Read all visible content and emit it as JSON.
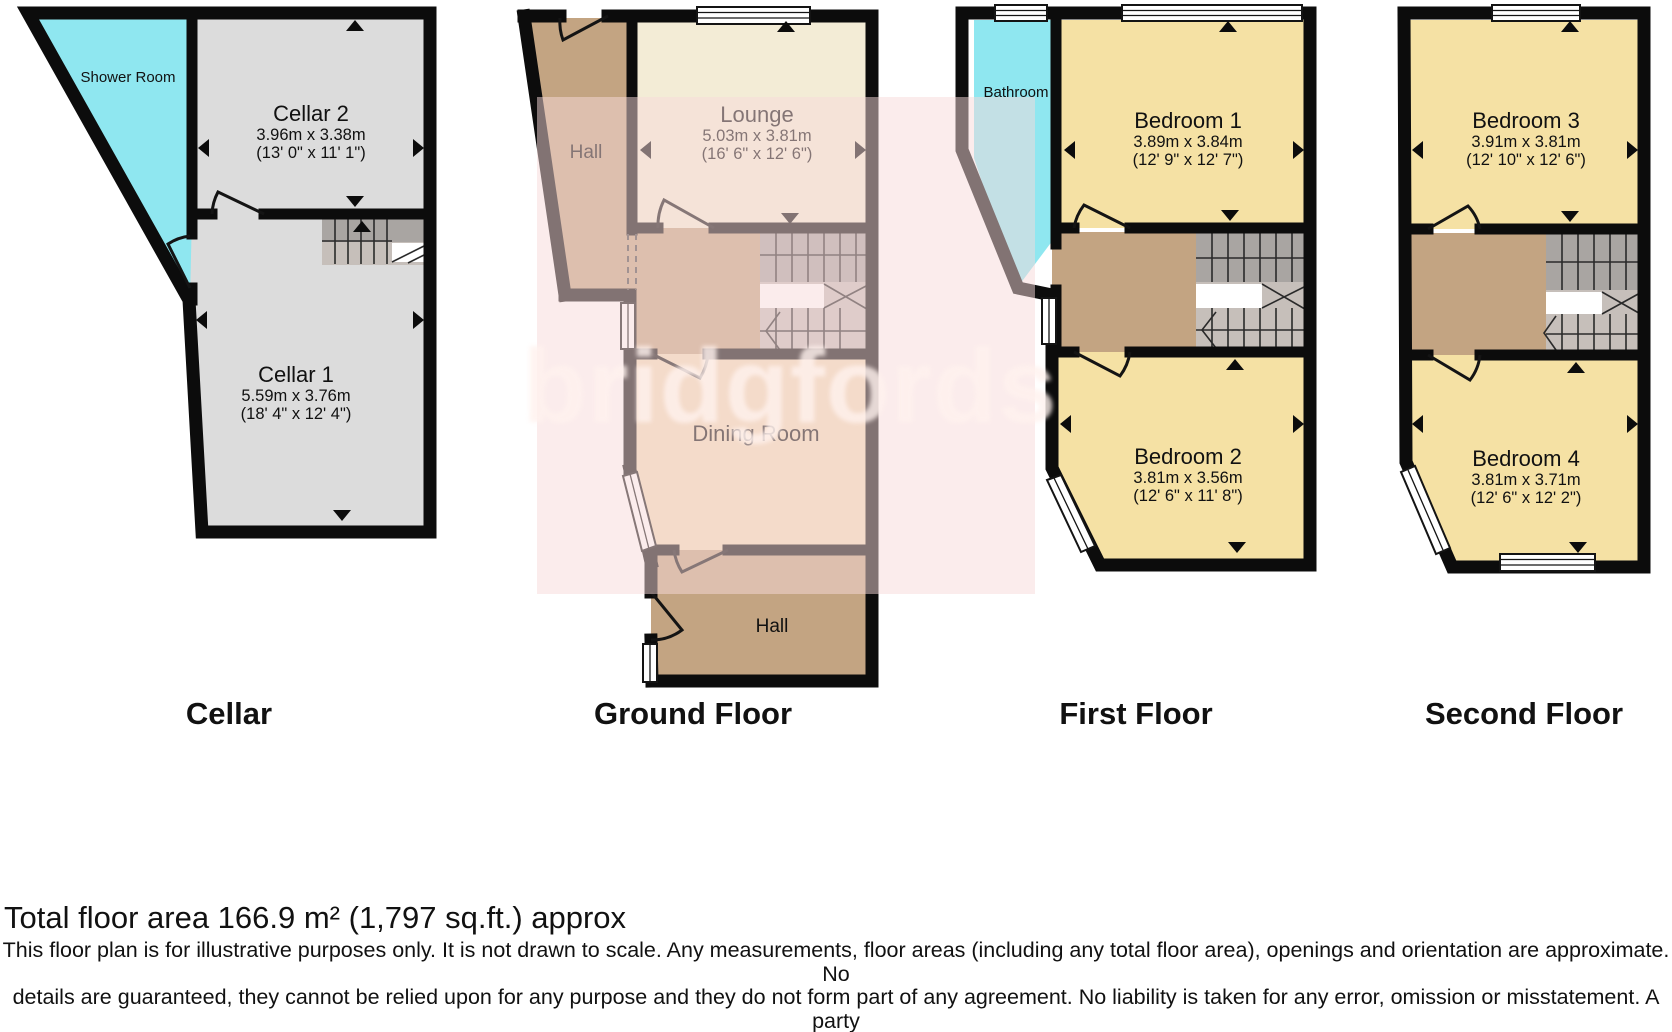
{
  "watermark": {
    "text": "bridgfords"
  },
  "floors": [
    {
      "label": "Cellar",
      "rooms": [
        {
          "name": "Shower Room",
          "dims_m": "",
          "dims_ft": ""
        },
        {
          "name": "Cellar 2",
          "dims_m": "3.96m x 3.38m",
          "dims_ft": "(13' 0\" x 11' 1\")"
        },
        {
          "name": "Cellar 1",
          "dims_m": "5.59m x 3.76m",
          "dims_ft": "(18' 4\" x 12' 4\")"
        }
      ]
    },
    {
      "label": "Ground Floor",
      "rooms": [
        {
          "name": "Hall",
          "dims_m": "",
          "dims_ft": ""
        },
        {
          "name": "Lounge",
          "dims_m": "5.03m x 3.81m",
          "dims_ft": "(16' 6\" x 12' 6\")"
        },
        {
          "name": "Dining Room",
          "dims_m": "",
          "dims_ft": ""
        },
        {
          "name": "Hall",
          "dims_m": "",
          "dims_ft": ""
        }
      ]
    },
    {
      "label": "First Floor",
      "rooms": [
        {
          "name": "Bathroom",
          "dims_m": "",
          "dims_ft": ""
        },
        {
          "name": "Bedroom 1",
          "dims_m": "3.89m x 3.84m",
          "dims_ft": "(12' 9\" x 12' 7\")"
        },
        {
          "name": "Bedroom 2",
          "dims_m": "3.81m x 3.56m",
          "dims_ft": "(12' 6\" x 11' 8\")"
        }
      ]
    },
    {
      "label": "Second Floor",
      "rooms": [
        {
          "name": "Bedroom 3",
          "dims_m": "3.91m x 3.81m",
          "dims_ft": "(12' 10\" x 12' 6\")"
        },
        {
          "name": "Bedroom 4",
          "dims_m": "3.81m x 3.71m",
          "dims_ft": "(12' 6\" x 12' 2\")"
        }
      ]
    }
  ],
  "footer": {
    "total_area": "Total floor area 166.9 m² (1,797 sq.ft.) approx",
    "disclaimer_lines": [
      "This floor plan is for illustrative purposes only. It is not drawn to scale. Any measurements, floor areas (including any total floor area), openings and orientation are approximate. No",
      "details are guaranteed, they cannot be relied upon for any purpose and they do not form part of any agreement. No liability is taken for any error, omission or misstatement. A party",
      "must rely upon its own inspection(s). Powered by www.focalagent.com"
    ]
  },
  "colors": {
    "wall": "#0c0c0c",
    "bedroom": "#f5e1a4",
    "wet_room": "#8fe7f0",
    "hall": "#c3a482",
    "lounge": "#f3ecd6",
    "dining": "#f0ddba",
    "cellar": "#dcdcdc",
    "stairs_dark": "#a9a5a2",
    "stairs_light": "#c6bfba",
    "watermark_pink": "#f7d9d9"
  }
}
